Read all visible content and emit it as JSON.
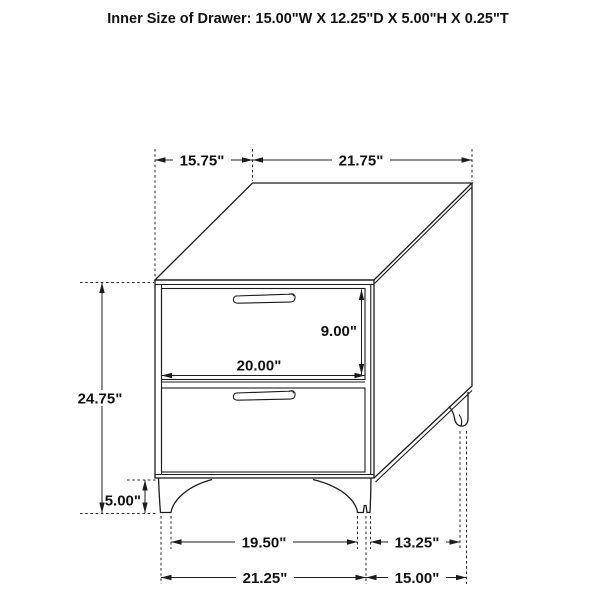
{
  "title": "Inner Size of Drawer: 15.00\"W X 12.25\"D X 5.00\"H X 0.25\"T",
  "drawing": {
    "subject": "two-drawer nightstand isometric line drawing",
    "line_color": "#1c1c1c",
    "background": "#ffffff"
  },
  "dimensions": {
    "top_depth": "15.75\"",
    "top_width": "21.75\"",
    "drawer_opening_height": "9.00\"",
    "drawer_opening_width": "20.00\"",
    "overall_height": "24.75\"",
    "leg_height": "5.00\"",
    "front_feet_inner_span": "19.50\"",
    "side_feet_span": "13.25\"",
    "front_feet_outer_span": "21.25\"",
    "side_overall_span": "15.00\""
  }
}
